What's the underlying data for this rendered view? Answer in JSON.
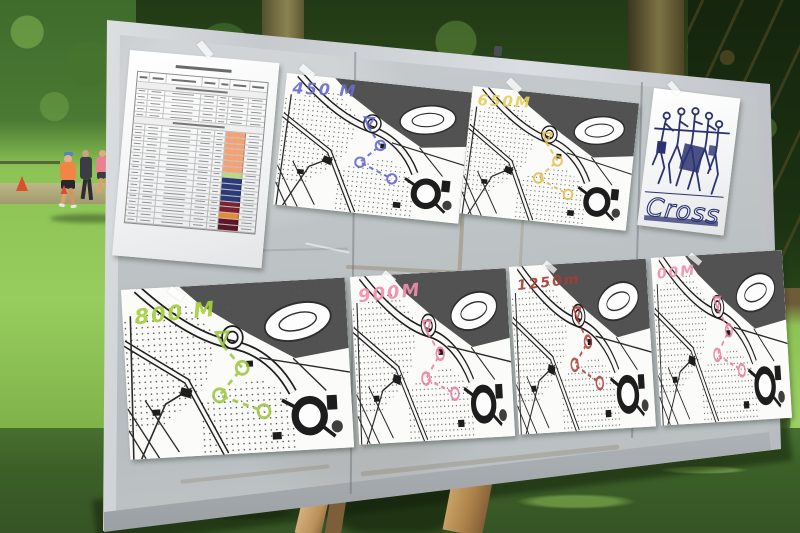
{
  "photo": {
    "board": {
      "surface_color": "#bfc4c7",
      "frame_color": "#d6dade",
      "maps": [
        {
          "label": "450 M",
          "label_color": "#6a6ec6",
          "course_color": "#5b63c8"
        },
        {
          "label": "650M",
          "label_color": "#e7cf5e",
          "course_color": "#e2bd4e"
        },
        {
          "label": "800 M",
          "label_color": "#a7cf3e",
          "course_color": "#9dc43c"
        },
        {
          "label": "900M",
          "label_color": "#f08fae",
          "course_color": "#e97c9d"
        },
        {
          "label": "1250m",
          "label_color": "#a63d36",
          "course_color": "#a63d36"
        },
        {
          "label": "00M",
          "label_color": "#ef8fac",
          "course_color": "#e87a9b"
        }
      ],
      "poster": {
        "title": "Cross",
        "ink_color": "#2b3270"
      },
      "results_sheet": {
        "sections": [
          {
            "rows": 5,
            "swatches": []
          },
          {
            "rows": 17,
            "swatches": [
              "#f2a273",
              "#f2a273",
              "#f2a273",
              "#f2a273",
              "#f2a273",
              "#f2a273",
              "#f2a273",
              "#b8dc7c",
              "#2c3a78",
              "#2c3a78",
              "#2c3a78",
              "#2c3a78",
              "#7c2130",
              "#7c2130",
              "#e58a35",
              "#5e1524",
              "#5e1524"
            ]
          }
        ]
      }
    }
  }
}
